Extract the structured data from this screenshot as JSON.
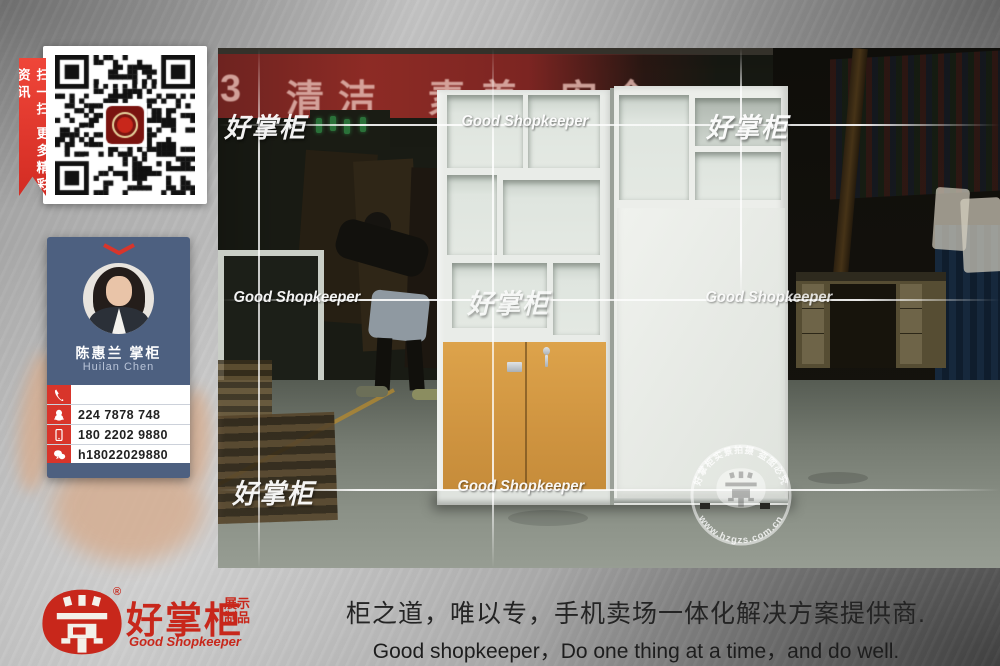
{
  "qr_panel": {
    "ribbon_text": "扫一扫 更多精彩资讯"
  },
  "business_card": {
    "name_cn": "陈惠兰 掌柜",
    "name_en": "Huilan Chen",
    "rows": [
      {
        "icon": "phone-icon",
        "value": ""
      },
      {
        "icon": "qq-icon",
        "value": "224 7878 748"
      },
      {
        "icon": "mobile-icon",
        "value": "180 2202 9880"
      },
      {
        "icon": "wechat-icon",
        "value": "h18022029880"
      },
      {
        "icon": "link-icon",
        "value": "http://user.qzone.qq.com/2247878748"
      }
    ]
  },
  "photo": {
    "banner": {
      "partial": "3",
      "words": [
        "清洁",
        "素养",
        "安全"
      ]
    },
    "watermark": {
      "cn": "好掌柜",
      "en": "Good Shopkeeper"
    },
    "stamp": {
      "top": "好掌柜实景拍摄 盗图必究",
      "bottom": "www.hzgzs.com.cn"
    }
  },
  "footer": {
    "registered": "®",
    "brand_cn": "好掌柜",
    "brand_sub1": "展示",
    "brand_sub2": "制品",
    "brand_en": "Good Shopkeeper",
    "slogan_cn": "柜之道，唯以专，手机卖场一体化解决方案提供商.",
    "slogan_en": "Good shopkeeper，Do one thing at a time，and do well."
  },
  "colors": {
    "accent_red": "#c8271b",
    "card_blue": "#4d6080",
    "door_orange": "#d79a41"
  }
}
